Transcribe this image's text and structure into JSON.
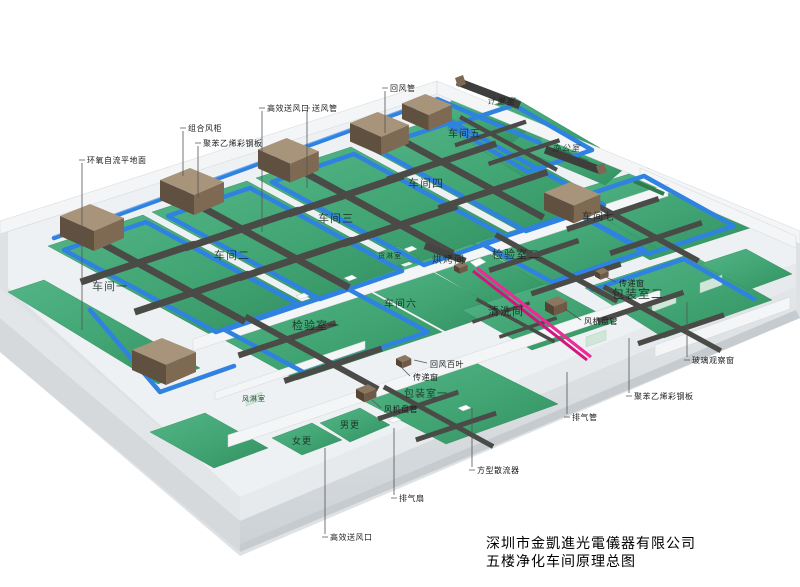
{
  "title_block": {
    "company": "深圳市金凱進光電儀器有限公司",
    "drawing_title": "五楼净化车间原理总图"
  },
  "rooms": [
    {
      "id": "workshop-1",
      "label": "车间一"
    },
    {
      "id": "workshop-2",
      "label": "车间二"
    },
    {
      "id": "workshop-3",
      "label": "车间三"
    },
    {
      "id": "workshop-4",
      "label": "车间四"
    },
    {
      "id": "workshop-5",
      "label": "车间五"
    },
    {
      "id": "workshop-6",
      "label": "车间六"
    },
    {
      "id": "workshop-7",
      "label": "车间七"
    },
    {
      "id": "metering-room",
      "label": "计量室"
    },
    {
      "id": "office",
      "label": "办公室"
    },
    {
      "id": "cargo-shower",
      "label": "货淋室"
    },
    {
      "id": "baking-room",
      "label": "烘烤间"
    },
    {
      "id": "inspection-room-2",
      "label": "检验室二"
    },
    {
      "id": "cleaning-room",
      "label": "清洗间"
    },
    {
      "id": "inspection-room-1",
      "label": "检验室一"
    },
    {
      "id": "packing-room-2",
      "label": "包装室二"
    },
    {
      "id": "packing-room-1",
      "label": "包装室一"
    },
    {
      "id": "air-shower",
      "label": "风淋室"
    },
    {
      "id": "mens-changing",
      "label": "男更"
    },
    {
      "id": "womens-changing",
      "label": "女更"
    }
  ],
  "annotations": [
    {
      "id": "epoxy-floor",
      "label": "环氧自流平地面"
    },
    {
      "id": "combined-ahu",
      "label": "组合风柜"
    },
    {
      "id": "steel-panel-left",
      "label": "聚苯乙烯彩钢板"
    },
    {
      "id": "hepa-outlet-top",
      "label": "高效送风口"
    },
    {
      "id": "supply-duct",
      "label": "送风管"
    },
    {
      "id": "return-duct",
      "label": "回风管"
    },
    {
      "id": "fan-coil-right",
      "label": "风机盘管"
    },
    {
      "id": "pass-box-right",
      "label": "传递窗"
    },
    {
      "id": "glass-window",
      "label": "玻璃观察窗"
    },
    {
      "id": "steel-panel-right",
      "label": "聚苯乙烯彩钢板"
    },
    {
      "id": "exhaust-duct",
      "label": "排气管"
    },
    {
      "id": "return-louver",
      "label": "回风百叶"
    },
    {
      "id": "pass-box-left",
      "label": "传递窗"
    },
    {
      "id": "fan-coil-left",
      "label": "风机盘管"
    },
    {
      "id": "square-diffuser",
      "label": "方型散流器"
    },
    {
      "id": "exhaust-fan",
      "label": "排气扇"
    },
    {
      "id": "hepa-outlet-bottom",
      "label": "高效送风口"
    }
  ],
  "colors": {
    "floor_green": "#41a473",
    "pipe_blue": "#2f82e0",
    "duct_gray": "#4a4a47",
    "ahu_brown": "#8a755f",
    "exhaust_pink": "#ee2a96",
    "slab_gray": "#d9dcde",
    "wall_white": "#f3f5f6"
  }
}
